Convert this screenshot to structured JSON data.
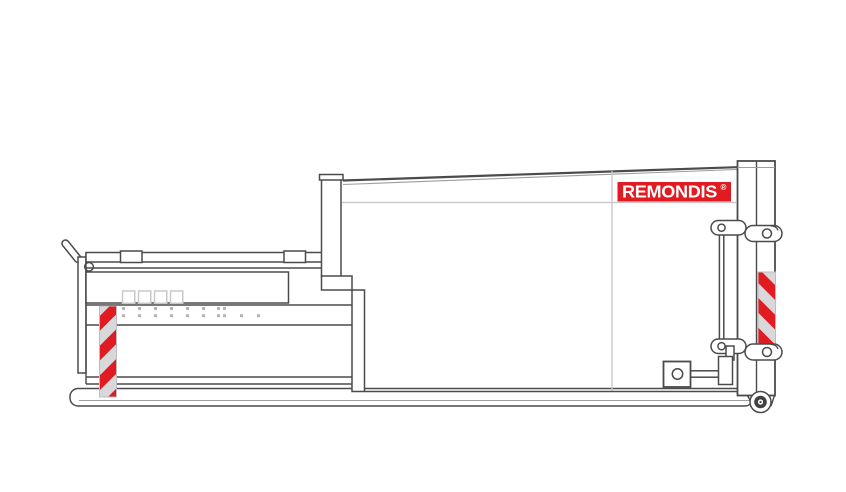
{
  "drawing": {
    "logo": {
      "text": "REMONDIS",
      "registered": "®"
    },
    "colors": {
      "background": "#ffffff",
      "outline": "#4b4b4d",
      "light_line": "#c9c9cb",
      "accent_red": "#e01b22",
      "hazard_background": "#d8d8da",
      "wheel_dark": "#414143"
    }
  }
}
